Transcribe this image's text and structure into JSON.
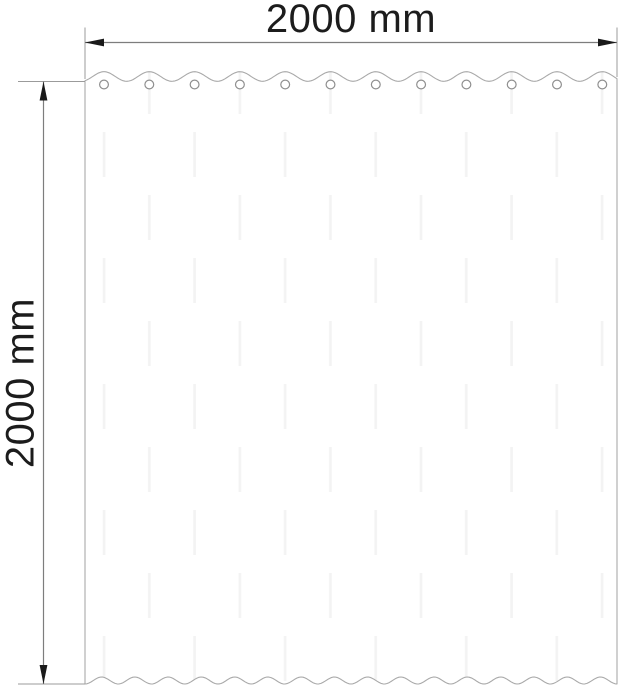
{
  "diagram": {
    "subject": "curtain panel with grommets",
    "width_dimension": {
      "label": "2000 mm"
    },
    "height_dimension": {
      "label": "2000 mm"
    },
    "grommet_count": 12,
    "colors": {
      "background": "#ffffff",
      "curtain_outline": "#a9a9a9",
      "grommet_outline": "#8f8f8f",
      "dimension_line": "#7d7d7d",
      "extension_line": "#9b9b9b",
      "arrow": "#1a1a1a",
      "label_text": "#1c1c1c",
      "streak": "#f3f3f3"
    }
  }
}
